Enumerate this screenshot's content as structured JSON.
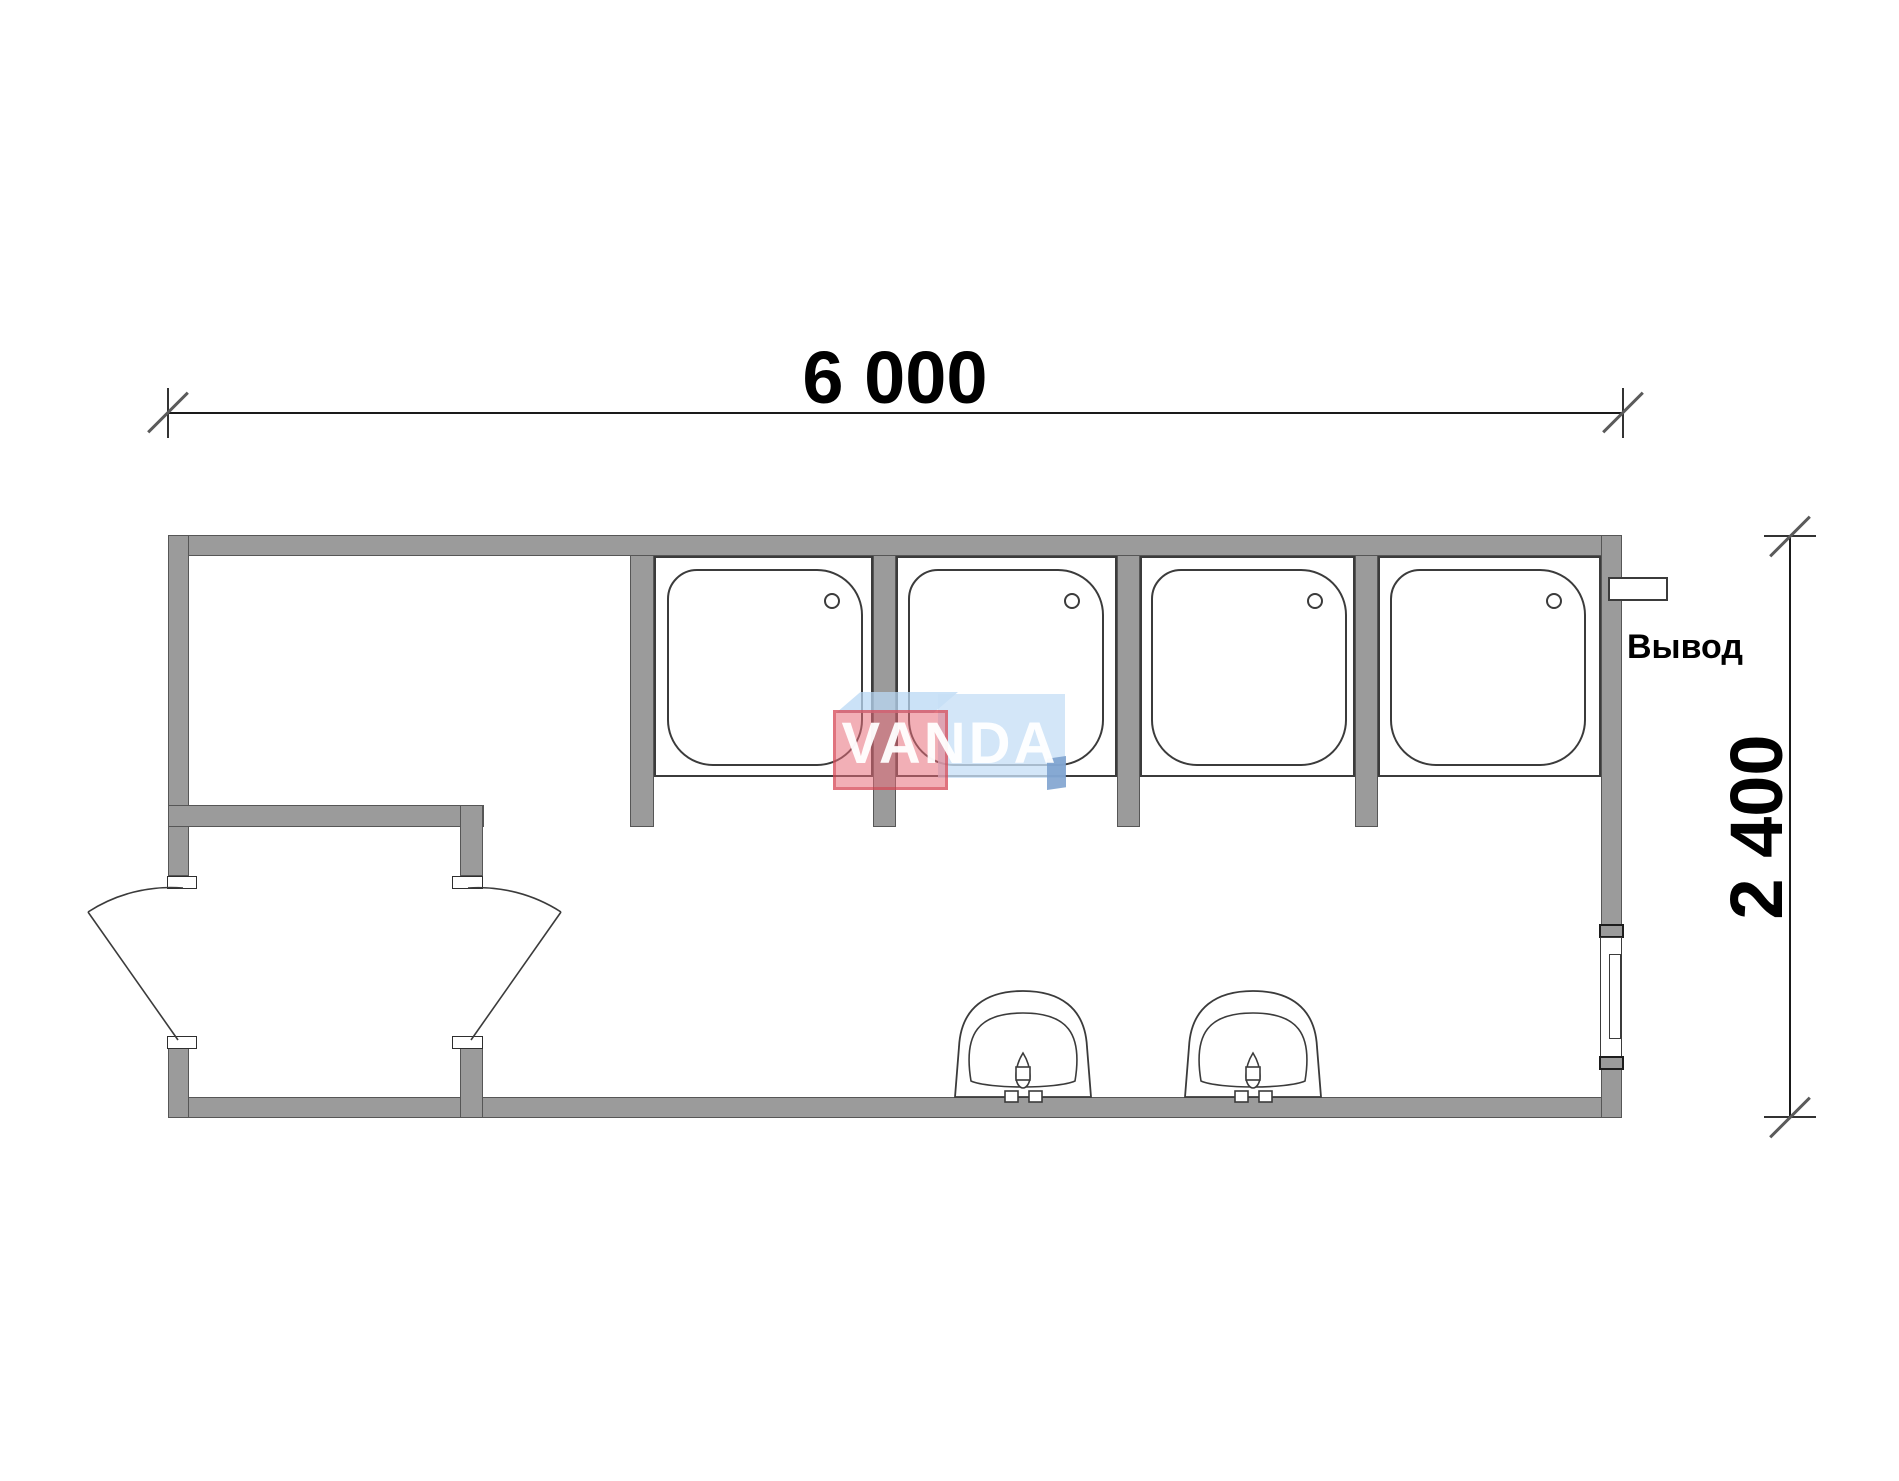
{
  "dimensions": {
    "width_label": "6 000",
    "height_label": "2 400"
  },
  "annotations": {
    "outlet_label": "Вывод"
  },
  "watermark": {
    "text": "VANDA"
  },
  "fixtures": {
    "shower_cabin_count": 4,
    "wash_basin_count": 2,
    "swing_door_count": 2,
    "window_count": 1
  },
  "colors": {
    "wall": "#9b9b9b",
    "outline": "#3b3b3b",
    "dim-line": "#1a1a1a",
    "tick": "#5a5a5a",
    "text": "#000000",
    "logo-pink": "rgba(232,110,122,0.55)",
    "logo-pink-border": "rgba(205,55,70,0.5)",
    "logo-blue": "rgba(199,223,246,0.78)",
    "logo-blue-dark": "rgba(120,158,205,0.85)",
    "logo-top": "rgba(186,216,244,0.75)",
    "logo-text": "rgba(255,255,255,0.95)"
  }
}
